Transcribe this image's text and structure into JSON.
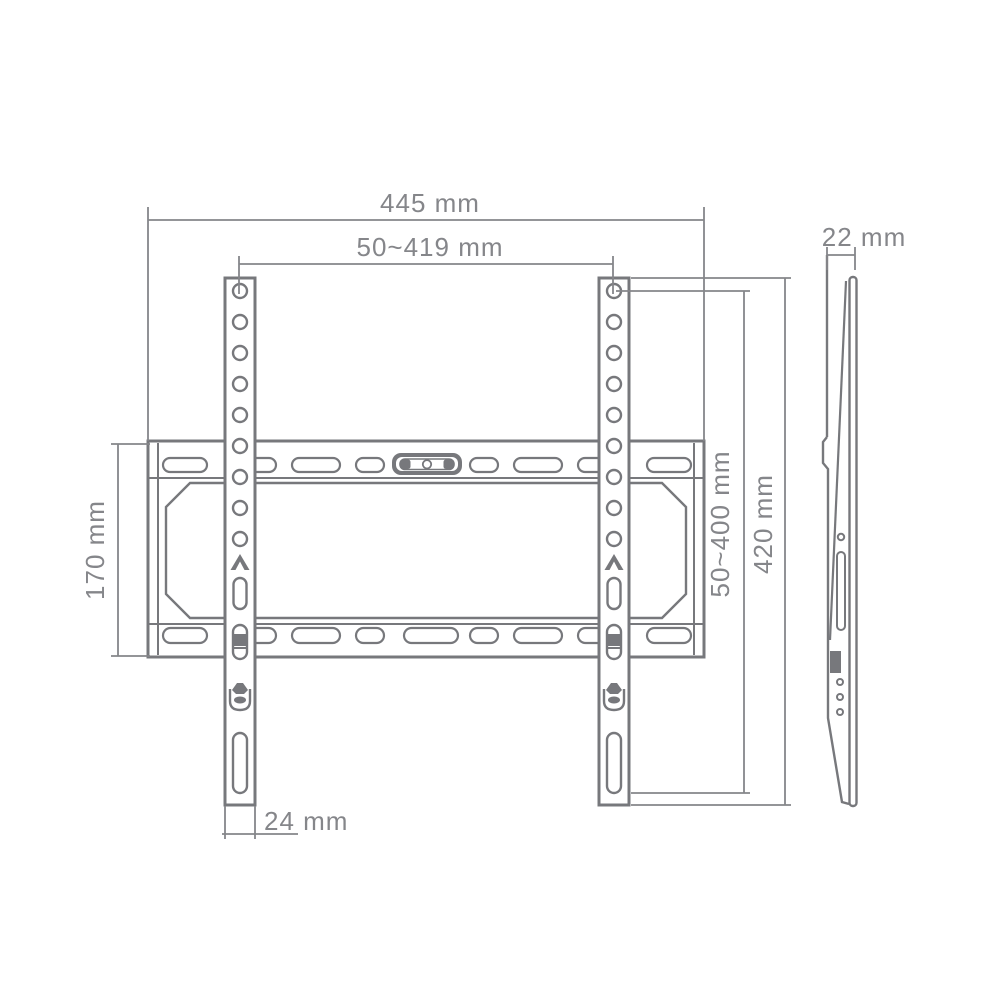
{
  "diagram": {
    "type": "technical-drawing",
    "subject": "TV wall mount bracket dimension drawing, front view and side view",
    "colors": {
      "part_line": "#77787c",
      "dimension_line": "#85868a",
      "label_text": "#85868a",
      "background": "#ffffff"
    },
    "views": {
      "front": "front-view",
      "side": "side-view"
    },
    "dimensions": {
      "overall_width": "445 mm",
      "vesa_width_range": "50~419 mm",
      "depth": "22 mm",
      "wall_plate_height": "170 mm",
      "vesa_height_range": "50~400 mm",
      "bracket_height": "420 mm",
      "bracket_width": "24 mm"
    },
    "icons": [
      "arrow-up-marker-icon",
      "hook-lock-icon",
      "spirit-level-icon"
    ]
  }
}
